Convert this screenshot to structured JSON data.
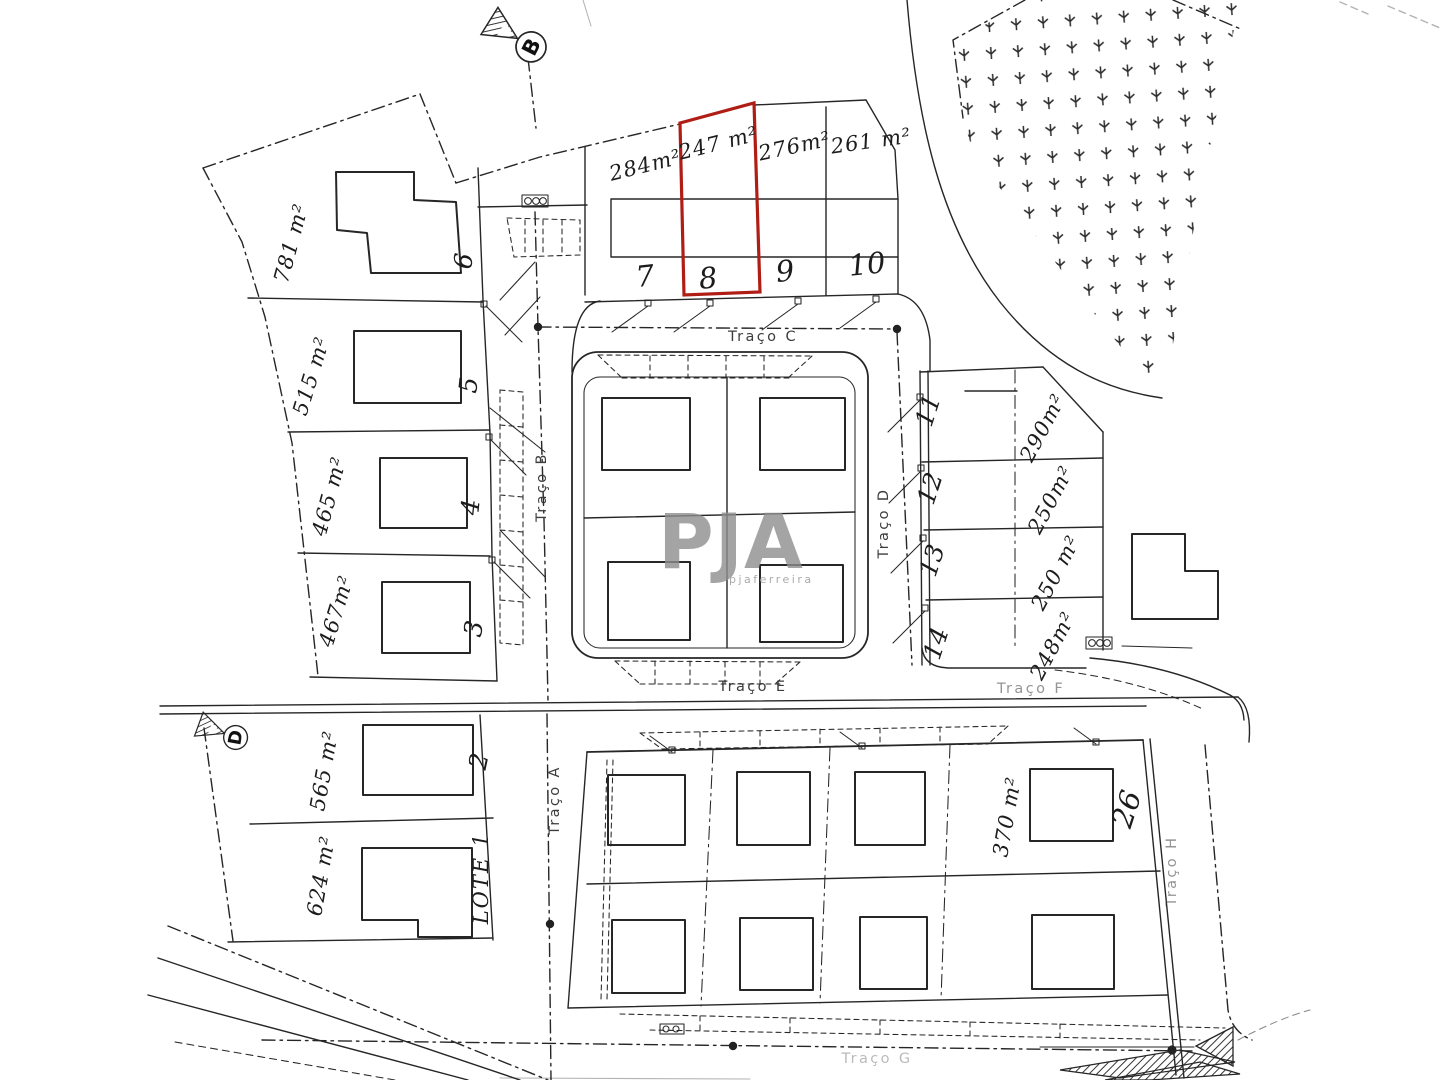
{
  "plan": {
    "watermark": {
      "text": "PJA",
      "subtext": "pjaferreira"
    },
    "markers": {
      "b": "B",
      "d": "D"
    },
    "streets": {
      "a": "Traço A",
      "b": "Traço B",
      "c": "Traço C",
      "d": "Traço D",
      "e": "Traço E",
      "f": "Traço F",
      "g": "Traço G",
      "h": "Traço H"
    },
    "plots": {
      "p1": {
        "number": "LOTE 1",
        "area": "624 m²"
      },
      "p2": {
        "number": "2",
        "area": "565 m²"
      },
      "p3": {
        "number": "3",
        "area": "467m²"
      },
      "p4": {
        "number": "4",
        "area": "465 m²"
      },
      "p5": {
        "number": "5",
        "area": "515 m²"
      },
      "p6": {
        "number": "6",
        "area": "781 m²"
      },
      "p7": {
        "number": "7",
        "area": "284m²"
      },
      "p8": {
        "number": "8",
        "area": "247 m²"
      },
      "p9": {
        "number": "9",
        "area": "276m²"
      },
      "p10": {
        "number": "10",
        "area": "261 m²"
      },
      "p11": {
        "number": "11",
        "area": "290m²"
      },
      "p12": {
        "number": "12",
        "area": "250m²"
      },
      "p13": {
        "number": "13",
        "area": "250 m²"
      },
      "p14": {
        "number": "14",
        "area": "248m²"
      },
      "p26": {
        "number": "26",
        "area": "370 m²"
      }
    },
    "colors": {
      "ink": "#262626",
      "highlight": "#b01d15",
      "watermark": "#8e8e8e",
      "paper": "#ffffff"
    }
  }
}
